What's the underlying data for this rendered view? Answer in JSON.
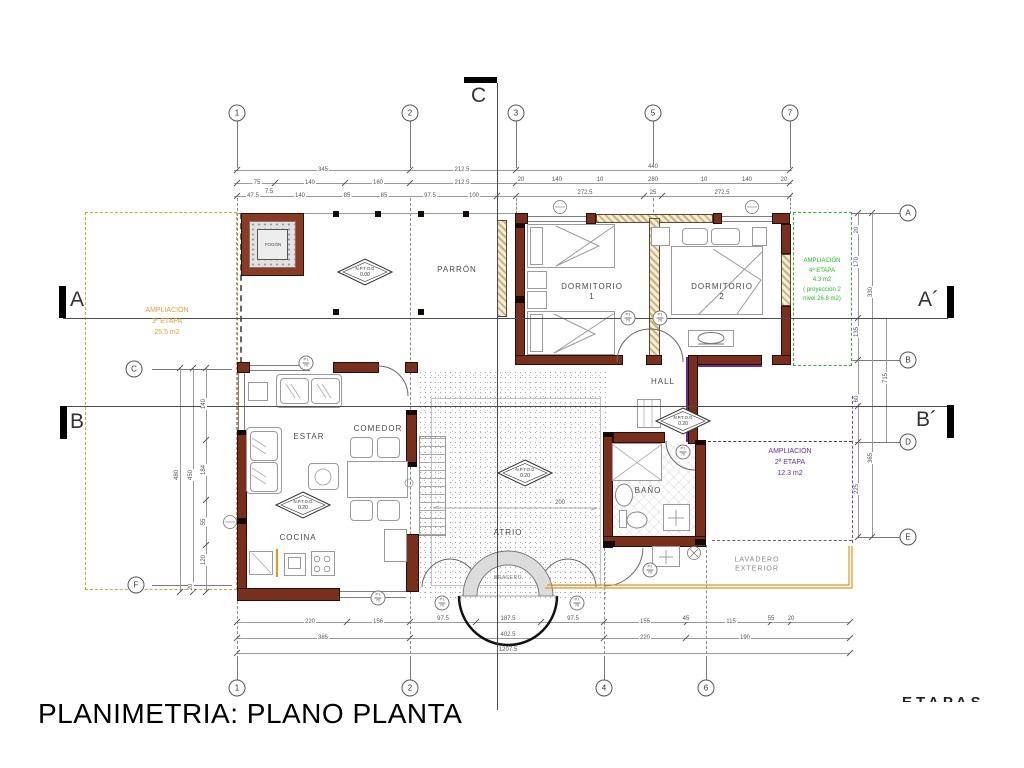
{
  "title": "PLANIMETRIA: PLANO PLANTA",
  "etapas_partial": "ETAPAS",
  "rooms": {
    "parron": "PARRÓN",
    "dorm1_l1": "DORMITORIO",
    "dorm1_l2": "1",
    "dorm2_l1": "DORMITORIO",
    "dorm2_l2": "2",
    "hall": "HALL",
    "estar": "ESTAR",
    "comedor": "COMEDOR",
    "cocina": "COCINA",
    "atrio": "ATRIO",
    "bano": "BAÑO",
    "brasero": "BRASERO",
    "lavadero_l1": "LAVADERO",
    "lavadero_l2": "EXTERIOR",
    "fogon": "FOGÓN"
  },
  "levels": {
    "label": "N.P.T.O.G",
    "parron": "0.00",
    "estar": "0.20",
    "atrio": "0.20",
    "hall": "0.20"
  },
  "zones": {
    "etapa3": {
      "l1": "AMPLIACIÓN",
      "l2": "3ª ETAPA",
      "l3": "25.5 m2",
      "color": "#E5A02C"
    },
    "etapa4": {
      "l1": "AMPLIACIÓN",
      "l2": "4ª ETAPA",
      "l3": "4.3 m2",
      "l4": "( proyección 2",
      "l5": "nivel 26.8 m2)",
      "color": "#22C022"
    },
    "etapa2": {
      "l1": "AMPLIACIÓN",
      "l2": "2ª ETAPA",
      "l3": "12.3 m2",
      "color": "#5F2DB0"
    }
  },
  "grid": {
    "top": [
      "1",
      "2",
      "3",
      "5",
      "7"
    ],
    "bottom": [
      "1",
      "2",
      "4",
      "6"
    ],
    "right": [
      "A",
      "B",
      "D",
      "E"
    ],
    "left": [
      "C",
      "F"
    ]
  },
  "sections": {
    "a": "A",
    "a2": "A´",
    "b": "B",
    "b2": "B´",
    "c": "C"
  },
  "dims": {
    "top1": [
      "345",
      "212.5",
      "440"
    ],
    "top2": [
      "75",
      "140",
      "160",
      "212.5",
      "20",
      "140",
      "10",
      "280",
      "10",
      "140",
      "20"
    ],
    "top3": [
      "47.5",
      "7.5",
      "140",
      "85",
      "85",
      "97.5",
      "100",
      "272.5",
      "25",
      "272.5"
    ],
    "bot1": [
      "220",
      "156",
      "97.5",
      "187.5",
      "97.5",
      "155",
      "45",
      "115",
      "55",
      "20"
    ],
    "bot2": [
      "385",
      "402.5",
      "220",
      "190"
    ],
    "bot3": [
      "1207.5"
    ],
    "left": [
      "480",
      "450",
      "140",
      "184",
      "55",
      "120",
      "20"
    ],
    "right": [
      "20",
      "170",
      "330",
      "135",
      "715",
      "60",
      "365",
      "225"
    ],
    "atrio": "200"
  },
  "tags": {
    "top": "P1",
    "bottom": "70"
  }
}
